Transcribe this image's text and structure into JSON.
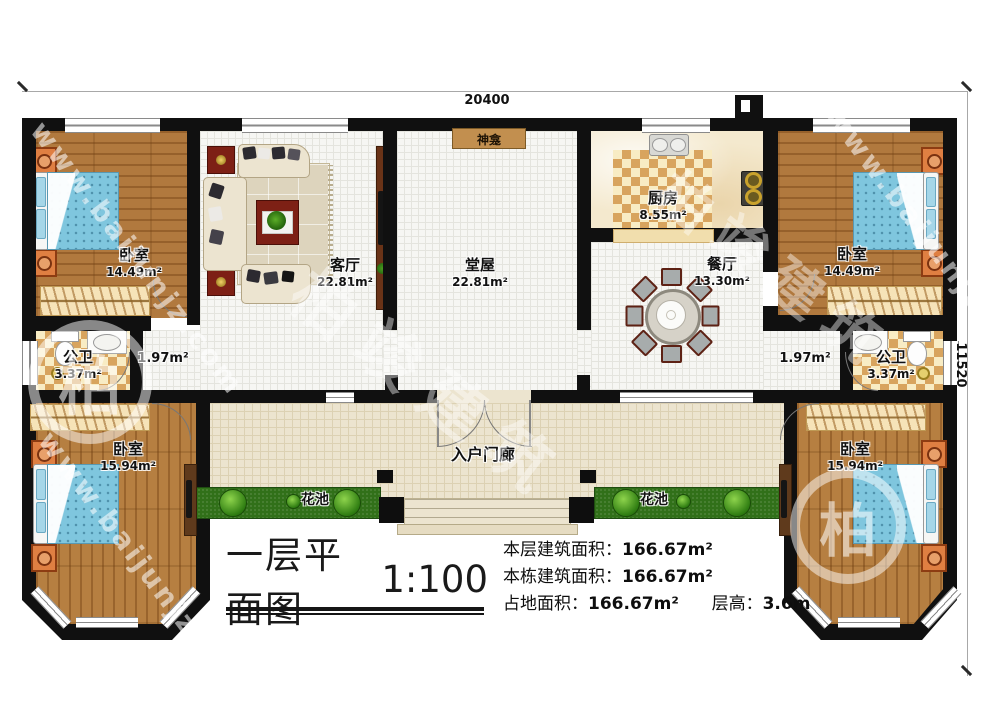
{
  "watermark": {
    "url": "www.baijunjz.com",
    "brand": "柏竣建筑"
  },
  "dimensions": {
    "width_mm": "20400",
    "height_mm": "11520"
  },
  "rooms": {
    "bedroom_tl": {
      "name": "卧室",
      "area": "14.49m²"
    },
    "living_room": {
      "name": "客厅",
      "area": "22.81m²"
    },
    "hall": {
      "name": "堂屋",
      "area": "22.81m²"
    },
    "kitchen": {
      "name": "厨房",
      "area": "8.55m²"
    },
    "dining_room": {
      "name": "餐厅",
      "area": "13.30m²"
    },
    "bedroom_tr": {
      "name": "卧室",
      "area": "14.49m²"
    },
    "bath_left": {
      "name": "公卫",
      "area": "3.37m²"
    },
    "bath_right": {
      "name": "公卫",
      "area": "3.37m²"
    },
    "corridor_left": {
      "area": "1.97m²"
    },
    "corridor_right": {
      "area": "1.97m²"
    },
    "bedroom_bl": {
      "name": "卧室",
      "area": "15.94m²"
    },
    "bedroom_br": {
      "name": "卧室",
      "area": "15.94m²"
    },
    "porch": {
      "name": "入户门廊"
    },
    "flower_bed_left": {
      "name": "花池"
    },
    "flower_bed_right": {
      "name": "花池"
    },
    "shrine": {
      "name": "神龛"
    }
  },
  "title": {
    "text": "一层平面图",
    "scale": "1:100"
  },
  "stats": {
    "floor_area_label": "本层建筑面积：",
    "floor_area_value": "166.67m²",
    "building_area_label": "本栋建筑面积：",
    "building_area_value": "166.67m²",
    "footprint_label": "占地面积：",
    "footprint_value": "166.67m²",
    "story_height_label": "层高：",
    "story_height_value": "3.6m"
  }
}
